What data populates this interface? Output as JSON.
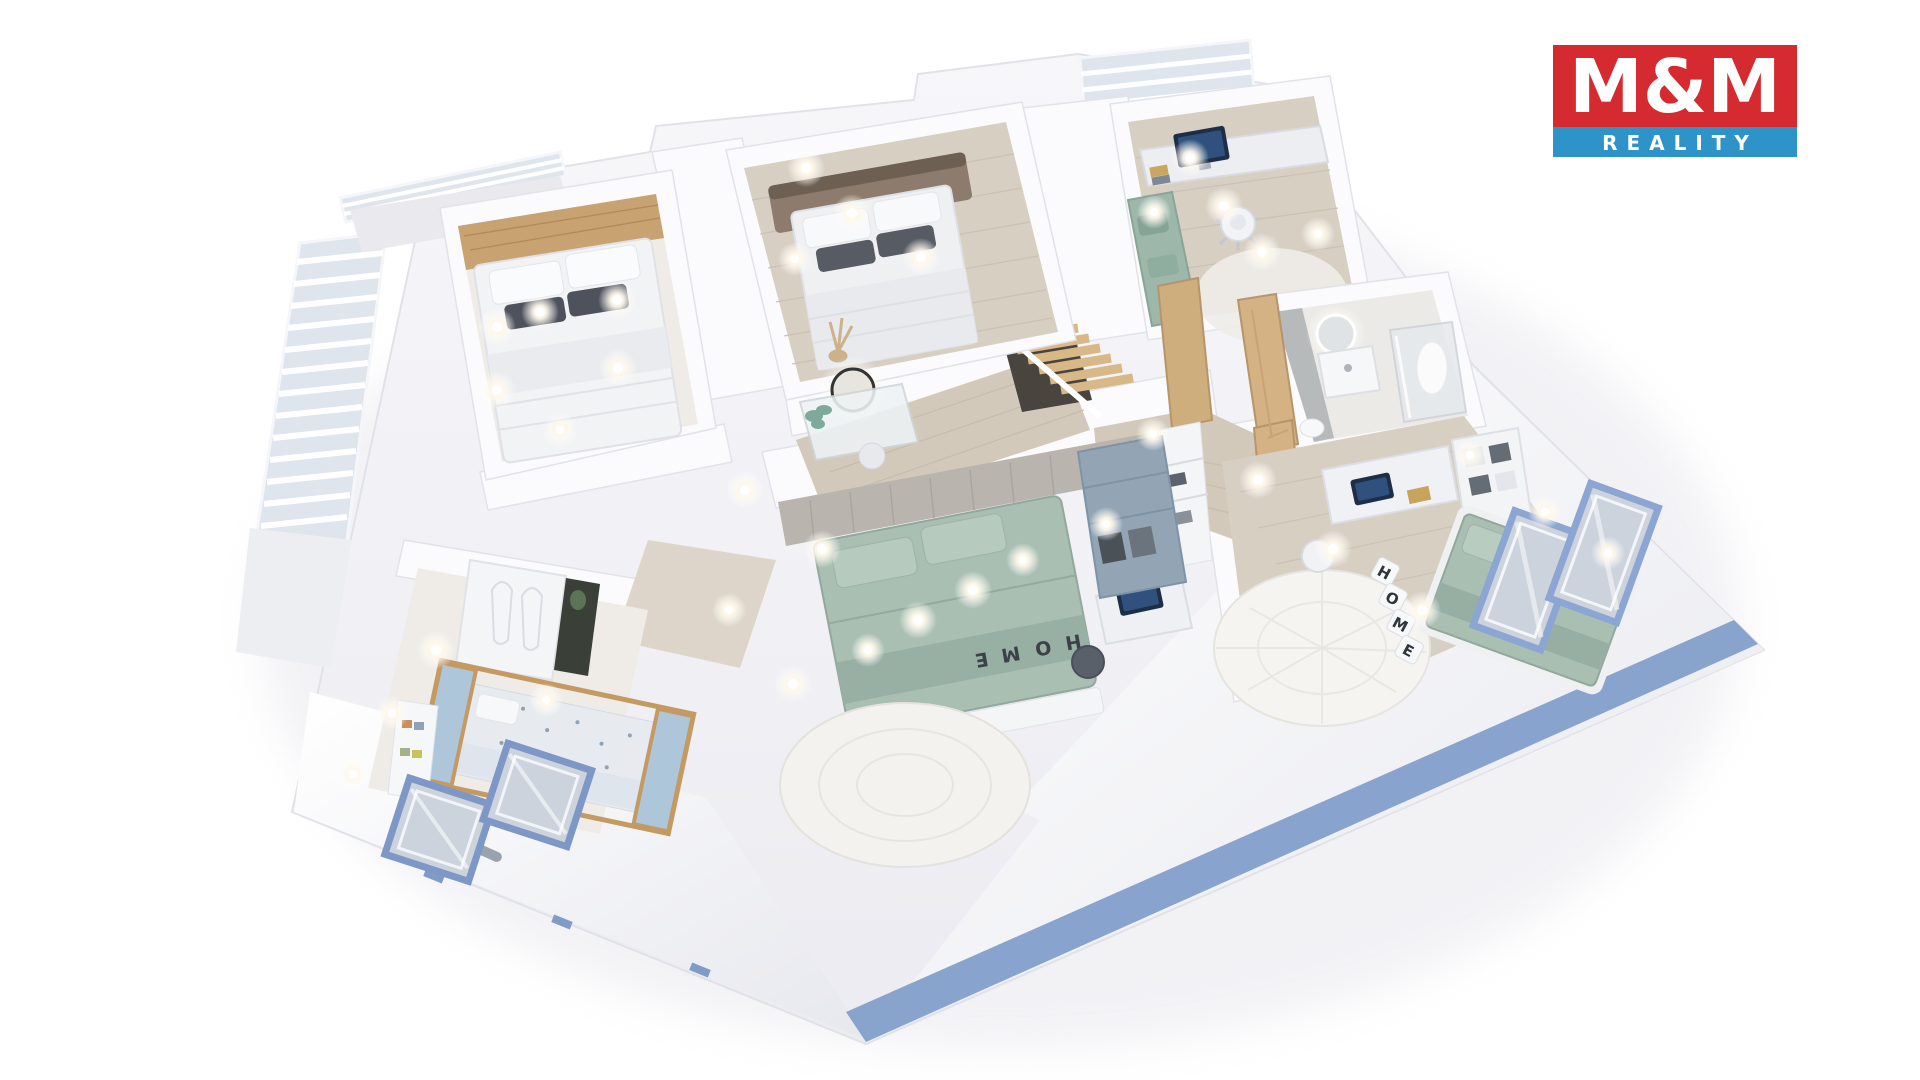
{
  "logo": {
    "line1": "M&M",
    "line2": "REALITY",
    "red": "#d52b30",
    "blue": "#2e93c9",
    "text_color": "#ffffff"
  },
  "decor": {
    "pillow_letters": [
      "H",
      "O",
      "M",
      "E"
    ],
    "bench_letters": [
      "H",
      "O",
      "M",
      "E"
    ]
  },
  "palette": {
    "plate": "#f3f4f7",
    "wall": "#fbfbfd",
    "wood_floor": "#d8cfc3",
    "hall_wood": "#d3c9bb",
    "roof": "#f4f5f8",
    "eave_blue": "#7f9cc9",
    "window_frame_blue": "#8ba6d3",
    "glass": "#ccd3dc",
    "sage_green": "#a9bfb2",
    "teal_daybed": "#9db7ab",
    "slate_wardrobe": "#93a5b5",
    "door_wood": "#d4b283",
    "accent_wood": "#c8a271",
    "gray_wood_wall": "#b9b4ad",
    "screen_navy": "#1f2e47",
    "screen_blue": "#30517e",
    "rug_cream": "#f3f2ef",
    "railing": "#dfe5ec"
  }
}
